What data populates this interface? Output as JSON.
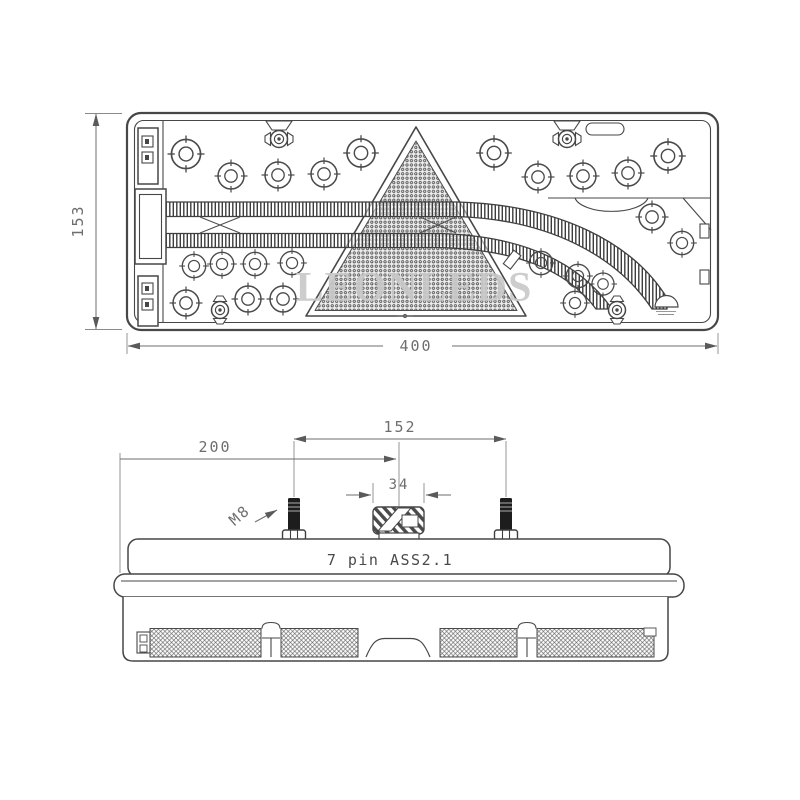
{
  "front_view": {
    "height_dim": "153",
    "width_dim": "400",
    "watermark": "LEONLEDS"
  },
  "top_view": {
    "offset_dim": "200",
    "stud_spacing_dim": "152",
    "connector_width_dim": "34",
    "stud_thread_label": "M8",
    "connector_label": "7 pin ASS2.1"
  },
  "colors": {
    "line": "#474747",
    "dimension_text": "#6e6e6e",
    "label_text": "#4a4a4a",
    "watermark": "#c9c9c9",
    "stud_fill": "#1d1d1d",
    "background": "#ffffff"
  }
}
